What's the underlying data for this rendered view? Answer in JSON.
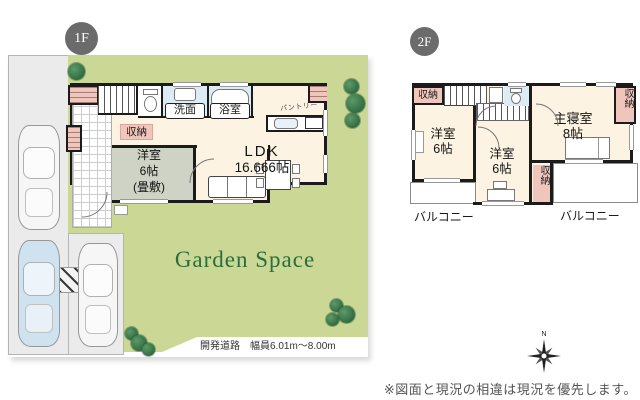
{
  "floor1": {
    "badge": "1F",
    "rooms": {
      "ldk": {
        "label": "LDK",
        "size": "16.666帖"
      },
      "tatami": {
        "label": "洋室",
        "size": "6帖",
        "note": "(畳敷)"
      },
      "washroom": {
        "label": "洗面"
      },
      "bathroom": {
        "label": "浴室"
      },
      "closet": {
        "label": "収納"
      },
      "pantry": {
        "label": "パントリー"
      }
    },
    "garden": {
      "title": "Garden Space"
    },
    "road_note": "開発道路　幅員6.01m〜8.00m"
  },
  "floor2": {
    "badge": "2F",
    "rooms": {
      "master": {
        "label": "主寝室",
        "size": "8帖"
      },
      "west_a": {
        "label": "洋室",
        "size": "6帖"
      },
      "west_b": {
        "label": "洋室",
        "size": "6帖"
      },
      "closet_top": {
        "label": "収納"
      },
      "closet_right": {
        "label": "収納"
      },
      "closet_mid": {
        "label": "収納"
      },
      "balcony_left": {
        "label": "バルコニー"
      },
      "balcony_right": {
        "label": "バルコニー"
      }
    }
  },
  "compass": {
    "north": "N"
  },
  "footer": {
    "disclaimer": "※図面と現況の相違は現況を優先します。"
  },
  "colors": {
    "garden_green": "#cad795",
    "floor_cream": "#fdf3e2",
    "tatami_gray": "#cfd3c5",
    "wet_blue": "#ddecf4",
    "closet_pink": "#f0c5bc",
    "wall_black": "#1b1b1b",
    "badge_gray": "#6c6b6b",
    "garden_text_green": "#2b6e3e"
  }
}
